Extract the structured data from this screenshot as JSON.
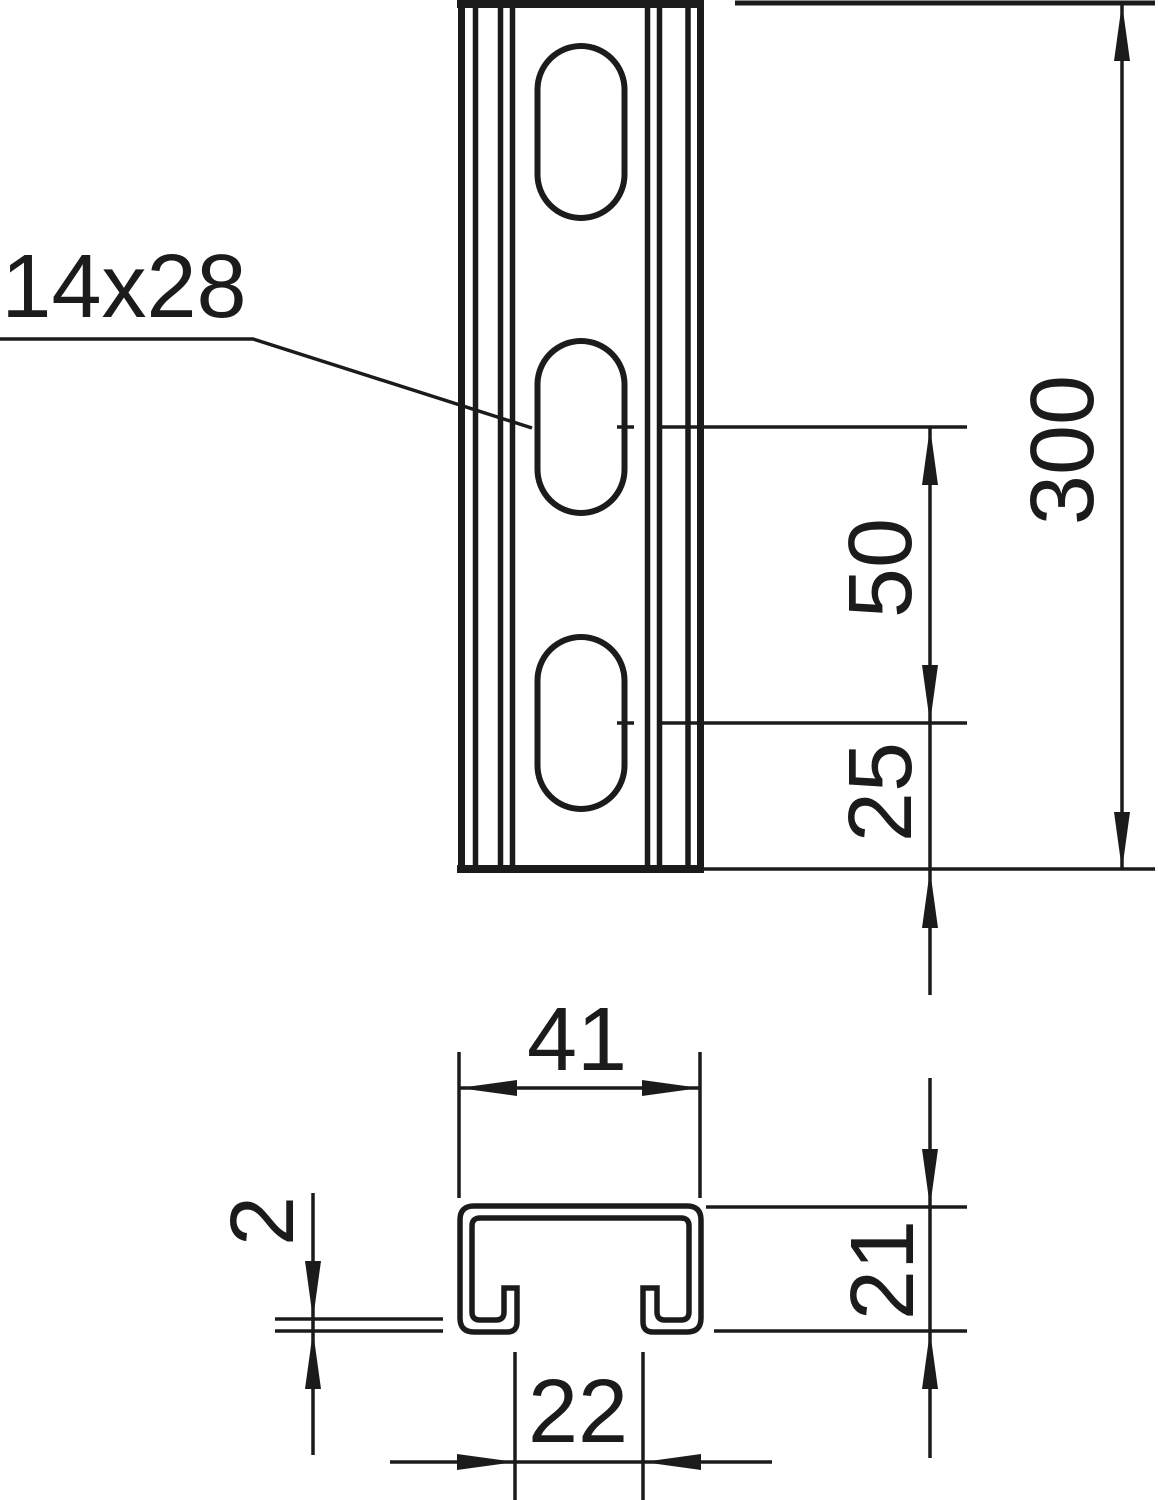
{
  "drawing": {
    "title": "slotted strut channel rail dimension drawing",
    "views": [
      "front-view-with-slots",
      "cross-section-profile"
    ],
    "labels": {
      "slot_size": "14x28",
      "total_length": "300",
      "slot_pitch": "50",
      "end_distance": "25",
      "profile_width": "41",
      "profile_height": "21",
      "opening_width": "22",
      "thickness": "2"
    },
    "dimensions": [
      {
        "name": "slot size",
        "value": "14x28",
        "kind": "callout-leader"
      },
      {
        "name": "total length",
        "value": "300",
        "kind": "vertical-dimension"
      },
      {
        "name": "slot pitch",
        "value": "50",
        "kind": "vertical-dimension"
      },
      {
        "name": "end distance",
        "value": "25",
        "kind": "vertical-dimension"
      },
      {
        "name": "profile width",
        "value": "41",
        "kind": "horizontal-dimension"
      },
      {
        "name": "profile height",
        "value": "21",
        "kind": "vertical-dimension"
      },
      {
        "name": "opening width",
        "value": "22",
        "kind": "horizontal-dimension"
      },
      {
        "name": "material thickness",
        "value": "2",
        "kind": "vertical-dimension"
      }
    ],
    "colors": {
      "ink": "#1b1b1b",
      "paper": "#ffffff"
    }
  }
}
